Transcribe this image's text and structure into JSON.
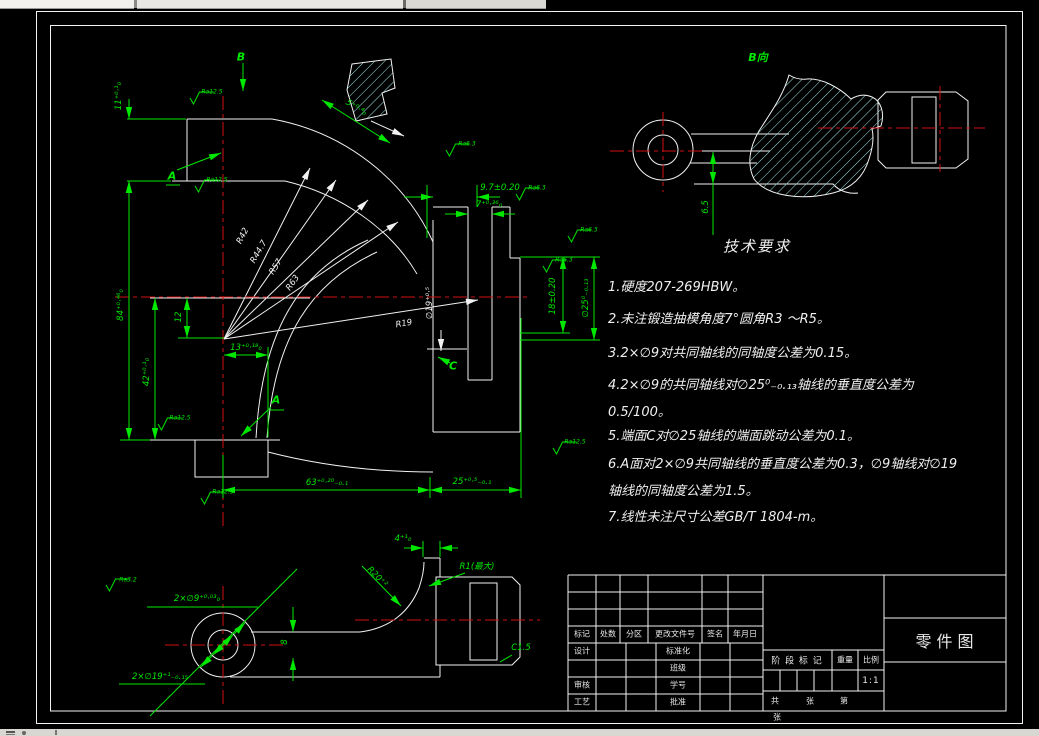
{
  "colors": {
    "line": "#f2f2f2",
    "dimension": "#00e800",
    "centerline": "#cf1010",
    "hatch": "#9fe4e4",
    "background": "#000000"
  },
  "main_view": {
    "b_label": "B",
    "datum_a_upper": "A",
    "datum_a_lower": "A",
    "face_c": "C",
    "dim_11": "11⁺⁰·¹₀",
    "dim_84": "84⁺⁰·⁴⁶₀",
    "dim_42": "42⁺⁰·¹₀",
    "dim_12": "12",
    "dim_13": "13⁺⁰·¹⁸₀",
    "dim_5": "5⁺⁰·⁴₀",
    "dim_9_7": "9.7±0.20",
    "dim_7": "7⁺⁰·³⁶₀",
    "dim_18": "18±0.20",
    "dim_d25": "∅25⁰₋₀.₁₃",
    "dim_d19": "∅19⁺⁰·⁵",
    "dim_63": "63⁺⁰·²⁰₋₀.₁",
    "dim_25": "25⁺⁰·⁵₋₀.₁",
    "r42": "R42",
    "r44_7": "R44.7",
    "r57": "R57",
    "r63": "R63",
    "r19": "R19",
    "ra_top_face": "Ra12.5",
    "ra_datum_a": "Ra12.5",
    "ra_neck": "Ra6.3",
    "ra_slot": "Ra6.3",
    "ra_boss_top": "Ra6.3",
    "ra_boss_side": "Ra6.3",
    "ra_jaw": "Ra12.5",
    "ra_bottom_face": "Ra12.5",
    "ra_side_face": "Ra12.5"
  },
  "b_view": {
    "title": "B向",
    "dim_6_5": "6.5"
  },
  "bottom_view": {
    "dim_2xd9": "2×∅9⁺⁰·⁰³₀",
    "ra_holes": "Ra3.2",
    "dim_2xd19": "2×∅19⁺¹₋₀.₁₅",
    "dim_8": "8",
    "dim_4": "4⁺¹₀",
    "dim_r20": "R20⁺²",
    "dim_r1": "R1(最大)",
    "dim_c15": "C1.5"
  },
  "tech_requirements": {
    "title": "技术要求",
    "lines": [
      "1.硬度207-269HBW。",
      "2.未注锻造抽模角度7°圆角R3 ～R5。",
      "3.2×∅9对共同轴线的同轴度公差为0.15。",
      "4.2×∅9的共同轴线对∅25⁰₋₀.₁₃轴线的垂直度公差为",
      "0.5/100。",
      "5.端面C对∅25轴线的端面跳动公差为0.1。",
      "6.A面对2×∅9共同轴线的垂直度公差为0.3，∅9轴线对∅19",
      "轴线的同轴度公差为1.5。",
      "7.线性未注尺寸公差GB/T 1804-m。"
    ]
  },
  "title_block": {
    "part_title": "零件图",
    "header": [
      "标记",
      "处数",
      "分区",
      "更改文件号",
      "签名",
      "年月日"
    ],
    "row_design": "设计",
    "row_check": "审核",
    "row_process": "工艺",
    "col_standard": "标准化",
    "col_class": "班级",
    "col_number": "学号",
    "col_approve": "批准",
    "stage": "阶 段 标 记",
    "weight": "重量",
    "scale": "比例",
    "scale_value": "1:1",
    "sheet_gong": "共",
    "sheet_zhang": "张",
    "sheet_di": "第",
    "sheet_overflow": "张"
  }
}
